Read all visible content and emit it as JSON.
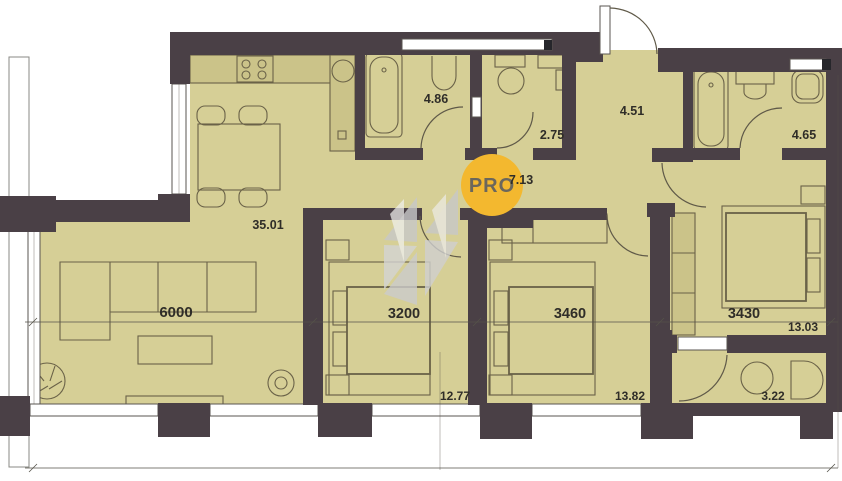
{
  "colors": {
    "floor": "#d6cf96",
    "floorDark": "#cbc389",
    "wall": "#4a4046",
    "line": "#6a6248",
    "dim": "#55524a",
    "text": "#2f2d28",
    "badgeBg": "#f3b82f",
    "badgeFg": "#6b675c",
    "watermark": "#c8c8c8"
  },
  "badge": {
    "label": "PRO"
  },
  "rooms": {
    "living_kitchen": {
      "area": "35.01"
    },
    "bathroom_1": {
      "area": "4.86"
    },
    "wc": {
      "area": "2.75"
    },
    "hall": {
      "area": "4.51"
    },
    "bathroom_2": {
      "area": "4.65"
    },
    "corridor": {
      "area": "7.13"
    },
    "bedroom_1": {
      "width": "3200",
      "area": "12.77"
    },
    "bedroom_2": {
      "width": "3460",
      "area": "13.82"
    },
    "bedroom_3": {
      "width": "3430",
      "area": "13.03"
    },
    "bathroom_3": {
      "area": "3.22"
    }
  },
  "dimensions": {
    "living_width": "6000"
  }
}
